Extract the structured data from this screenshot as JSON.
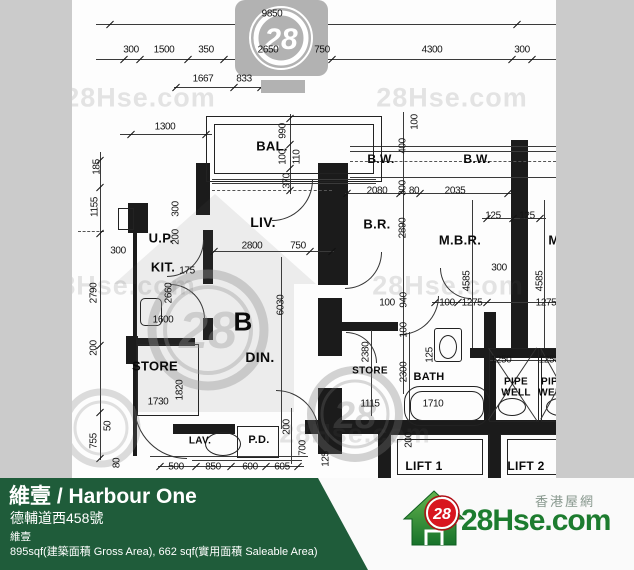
{
  "canvas": {
    "width": 634,
    "height": 570,
    "bg": "#cbcbcb",
    "plan_bg": "#fdfdfd",
    "line_color": "#1b1b1b"
  },
  "watermark": {
    "text": "28Hse.com",
    "badge": "28",
    "positions": [
      [
        140,
        98
      ],
      [
        452,
        98
      ],
      [
        120,
        286
      ],
      [
        448,
        286
      ],
      [
        355,
        434
      ]
    ]
  },
  "plan": {
    "walls": [
      [
        196,
        163,
        14,
        52
      ],
      [
        128,
        203,
        20,
        30
      ],
      [
        133,
        232,
        4,
        224
      ],
      [
        126,
        336,
        12,
        28
      ],
      [
        203,
        230,
        10,
        54
      ],
      [
        203,
        318,
        10,
        22
      ],
      [
        137,
        338,
        58,
        8
      ],
      [
        318,
        163,
        30,
        122
      ],
      [
        318,
        298,
        24,
        58
      ],
      [
        318,
        388,
        24,
        66
      ],
      [
        511,
        140,
        17,
        208
      ],
      [
        305,
        420,
        251,
        14
      ],
      [
        470,
        348,
        86,
        10
      ],
      [
        484,
        312,
        12,
        108
      ],
      [
        340,
        322,
        58,
        9
      ],
      [
        173,
        424,
        62,
        10
      ],
      [
        378,
        430,
        12,
        48
      ],
      [
        488,
        430,
        12,
        48
      ]
    ],
    "lines": [
      [
        96,
        24,
        460,
        "h"
      ],
      [
        96,
        59,
        460,
        "h"
      ],
      [
        174,
        87,
        128,
        "h"
      ],
      [
        120,
        134,
        92,
        "h"
      ],
      [
        100,
        152,
        308,
        "v"
      ],
      [
        290,
        114,
        80,
        "v"
      ],
      [
        212,
        251,
        122,
        "h"
      ],
      [
        281,
        257,
        172,
        "v"
      ],
      [
        345,
        193,
        166,
        "h"
      ],
      [
        403,
        112,
        282,
        "v"
      ],
      [
        482,
        218,
        64,
        "h"
      ],
      [
        432,
        302,
        124,
        "h"
      ],
      [
        472,
        200,
        148,
        "v"
      ],
      [
        544,
        200,
        148,
        "v"
      ],
      [
        371,
        330,
        86,
        "v"
      ],
      [
        409,
        332,
        88,
        "v"
      ],
      [
        490,
        360,
        66,
        "h"
      ],
      [
        158,
        466,
        146,
        "h"
      ],
      [
        291,
        408,
        56,
        "v"
      ],
      [
        350,
        146,
        206,
        "h"
      ],
      [
        350,
        151,
        206,
        "h"
      ],
      [
        350,
        177,
        206,
        "h"
      ],
      [
        212,
        179,
        164,
        "h"
      ],
      [
        212,
        183,
        164,
        "h"
      ],
      [
        150,
        456,
        158,
        "h"
      ],
      [
        192,
        460,
        110,
        "h"
      ]
    ],
    "dashes": [
      [
        212,
        190,
        120
      ],
      [
        350,
        161,
        206
      ],
      [
        78,
        231,
        26
      ]
    ],
    "ticks": [
      [
        110,
        24
      ],
      [
        517,
        24
      ],
      [
        124,
        59
      ],
      [
        140,
        59
      ],
      [
        188,
        59
      ],
      [
        224,
        59
      ],
      [
        312,
        59
      ],
      [
        332,
        59
      ],
      [
        512,
        59
      ],
      [
        532,
        59
      ],
      [
        176,
        87
      ],
      [
        234,
        87
      ],
      [
        261,
        87
      ],
      [
        131,
        134
      ],
      [
        206,
        134
      ],
      [
        100,
        160
      ],
      [
        100,
        187
      ],
      [
        100,
        233
      ],
      [
        100,
        345
      ],
      [
        100,
        412
      ],
      [
        100,
        458
      ],
      [
        214,
        251
      ],
      [
        310,
        251
      ],
      [
        332,
        251
      ],
      [
        347,
        193
      ],
      [
        400,
        193
      ],
      [
        420,
        193
      ],
      [
        508,
        193
      ],
      [
        487,
        218
      ],
      [
        513,
        218
      ],
      [
        540,
        218
      ],
      [
        435,
        302
      ],
      [
        458,
        302
      ],
      [
        487,
        302
      ],
      [
        160,
        466
      ],
      [
        196,
        466
      ],
      [
        231,
        466
      ],
      [
        266,
        466
      ],
      [
        298,
        466
      ],
      [
        290,
        118
      ],
      [
        290,
        144
      ],
      [
        290,
        168
      ],
      [
        290,
        190
      ]
    ],
    "boxes": [
      [
        206,
        116,
        174,
        64,
        0
      ],
      [
        214,
        124,
        158,
        48,
        0
      ],
      [
        137,
        344,
        60,
        70,
        0
      ],
      [
        404,
        386,
        84,
        38,
        16
      ],
      [
        410,
        391,
        72,
        28,
        12
      ],
      [
        434,
        328,
        26,
        32,
        3
      ],
      [
        237,
        426,
        40,
        30,
        0
      ],
      [
        140,
        298,
        20,
        26,
        5
      ],
      [
        118,
        208,
        14,
        20,
        0
      ],
      [
        390,
        434,
        98,
        44,
        0
      ],
      [
        397,
        439,
        84,
        34,
        0
      ],
      [
        500,
        434,
        56,
        44,
        0
      ],
      [
        507,
        439,
        49,
        34,
        0
      ],
      [
        489,
        348,
        48,
        72,
        0
      ],
      [
        541,
        348,
        40,
        72,
        0
      ]
    ],
    "ellipses": [
      [
        205,
        432,
        34,
        22
      ],
      [
        439,
        335,
        16,
        22
      ],
      [
        498,
        398,
        26,
        16
      ],
      [
        546,
        398,
        26,
        16
      ]
    ],
    "arcs": [
      [
        134,
        406,
        52,
        "bl"
      ],
      [
        167,
        240,
        36,
        "br"
      ],
      [
        170,
        284,
        34,
        "tr"
      ],
      [
        272,
        180,
        40,
        "br"
      ],
      [
        345,
        252,
        36,
        "br"
      ],
      [
        440,
        268,
        30,
        "bl"
      ],
      [
        400,
        296,
        38,
        "br"
      ],
      [
        346,
        332,
        30,
        "tr"
      ],
      [
        276,
        390,
        42,
        "tr"
      ]
    ],
    "diags": [
      [
        489,
        348,
        87,
        56.3
      ],
      [
        537,
        348,
        87,
        123.7
      ],
      [
        541,
        348,
        82,
        60.9
      ],
      [
        581,
        348,
        82,
        119.1
      ]
    ],
    "dims": [
      [
        "9850",
        272,
        14,
        0
      ],
      [
        "300",
        131,
        50,
        0
      ],
      [
        "1500",
        164,
        50,
        0
      ],
      [
        "350",
        206,
        50,
        0
      ],
      [
        "2650",
        268,
        50,
        0
      ],
      [
        "750",
        322,
        50,
        0
      ],
      [
        "4300",
        432,
        50,
        0
      ],
      [
        "300",
        522,
        50,
        0
      ],
      [
        "1667",
        203,
        79,
        0
      ],
      [
        "833",
        244,
        79,
        0
      ],
      [
        "1300",
        165,
        127,
        0
      ],
      [
        "185",
        97,
        167,
        1
      ],
      [
        "1155",
        95,
        207,
        1
      ],
      [
        "300",
        118,
        251,
        0
      ],
      [
        "2790",
        94,
        293,
        1
      ],
      [
        "200",
        94,
        348,
        1
      ],
      [
        "755",
        94,
        441,
        1
      ],
      [
        "50",
        108,
        426,
        1
      ],
      [
        "80",
        117,
        463,
        1
      ],
      [
        "990",
        283,
        131,
        1
      ],
      [
        "100",
        283,
        157,
        1
      ],
      [
        "110",
        297,
        157,
        1
      ],
      [
        "370",
        287,
        181,
        1
      ],
      [
        "300",
        176,
        209,
        1
      ],
      [
        "200",
        176,
        237,
        1
      ],
      [
        "175",
        187,
        271,
        0
      ],
      [
        "2660",
        169,
        293,
        1
      ],
      [
        "1600",
        163,
        320,
        0
      ],
      [
        "2800",
        252,
        246,
        0
      ],
      [
        "750",
        298,
        246,
        0
      ],
      [
        "6030",
        281,
        305,
        1
      ],
      [
        "1730",
        158,
        402,
        0
      ],
      [
        "1820",
        180,
        390,
        1
      ],
      [
        "100",
        415,
        122,
        1
      ],
      [
        "400",
        403,
        146,
        1
      ],
      [
        "300",
        403,
        188,
        1
      ],
      [
        "2080",
        377,
        191,
        0
      ],
      [
        "80",
        414,
        191,
        0
      ],
      [
        "2035",
        455,
        191,
        0
      ],
      [
        "2890",
        403,
        228,
        1
      ],
      [
        "125",
        493,
        216,
        0
      ],
      [
        "125",
        527,
        216,
        0
      ],
      [
        "4585",
        467,
        281,
        1
      ],
      [
        "300",
        499,
        268,
        0
      ],
      [
        "4585",
        540,
        281,
        1
      ],
      [
        "100",
        387,
        303,
        0
      ],
      [
        "100",
        447,
        303,
        0
      ],
      [
        "1275",
        472,
        303,
        0
      ],
      [
        "1275",
        546,
        303,
        0
      ],
      [
        "940",
        404,
        300,
        1
      ],
      [
        "100",
        404,
        330,
        1
      ],
      [
        "2380",
        366,
        352,
        1
      ],
      [
        "2300",
        404,
        372,
        1
      ],
      [
        "125",
        430,
        355,
        1
      ],
      [
        "1115",
        370,
        404,
        0
      ],
      [
        "1710",
        433,
        404,
        0
      ],
      [
        "1250",
        501,
        360,
        0
      ],
      [
        "1250",
        549,
        360,
        0
      ],
      [
        "200",
        287,
        427,
        1
      ],
      [
        "700",
        303,
        448,
        1
      ],
      [
        "500",
        176,
        467,
        0
      ],
      [
        "850",
        213,
        467,
        0
      ],
      [
        "600",
        250,
        467,
        0
      ],
      [
        "605",
        282,
        467,
        0
      ],
      [
        "125",
        326,
        459,
        1
      ],
      [
        "200",
        409,
        440,
        1
      ]
    ],
    "rooms": [
      [
        "BAL.",
        272,
        146,
        13
      ],
      [
        "U.P.",
        161,
        238,
        13
      ],
      [
        "LIV.",
        263,
        222,
        14
      ],
      [
        "KIT.",
        163,
        267,
        13
      ],
      [
        "B",
        243,
        322,
        26
      ],
      [
        "DIN.",
        260,
        357,
        14
      ],
      [
        "STORE",
        155,
        366,
        13
      ],
      [
        "B.R.",
        377,
        224,
        13
      ],
      [
        "M.B.R.",
        460,
        240,
        13
      ],
      [
        "B.W.",
        381,
        159,
        12
      ],
      [
        "B.W.",
        477,
        159,
        12
      ],
      [
        "M",
        554,
        240,
        13
      ],
      [
        "STORE",
        370,
        371,
        10
      ],
      [
        "BATH",
        429,
        377,
        11
      ],
      [
        "LAV.",
        200,
        441,
        10
      ],
      [
        "P.D.",
        259,
        440,
        11
      ],
      [
        "PIPE",
        516,
        382,
        10
      ],
      [
        "WELL",
        516,
        393,
        10
      ],
      [
        "PIPE",
        553,
        382,
        10
      ],
      [
        "WELL",
        553,
        393,
        10
      ],
      [
        "LIFT 1",
        424,
        466,
        12
      ],
      [
        "LIFT 2",
        526,
        466,
        12
      ]
    ]
  },
  "footer": {
    "bg": "#1f5c3a",
    "title": "維壹 / Harbour One",
    "address": "德輔道西458號",
    "estate": "維壹",
    "area": "895sqf(建築面積 Gross Area), 662 sqf(實用面積 Saleable Area)"
  },
  "logo": {
    "site": "28Hse.com",
    "tagline": "香港屋網",
    "badge": "28",
    "green": "#1d7c2f",
    "red": "#d8161f"
  }
}
